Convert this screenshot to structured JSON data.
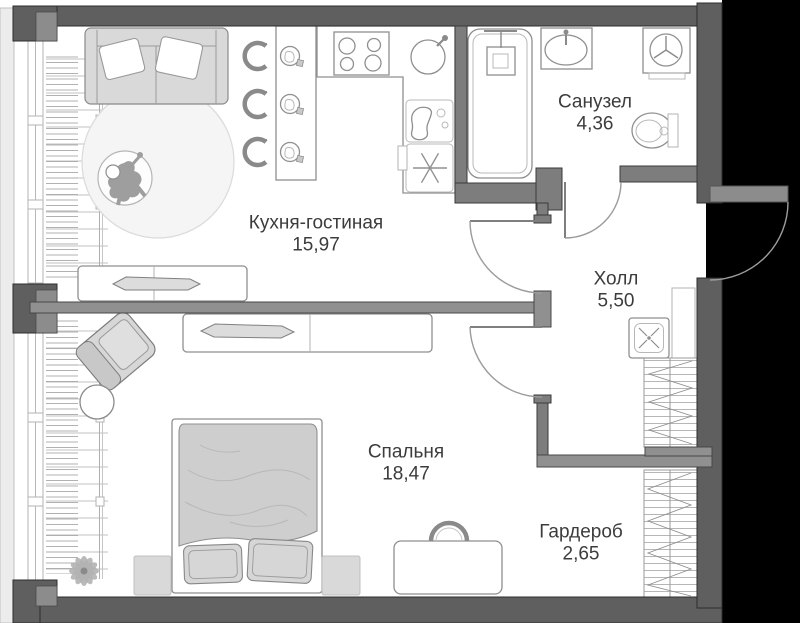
{
  "rooms": [
    {
      "id": "kitchen-living",
      "name": "Кухня-гостиная",
      "area": "15,97"
    },
    {
      "id": "bathroom",
      "name": "Санузел",
      "area": "4,36"
    },
    {
      "id": "hall",
      "name": "Холл",
      "area": "5,50"
    },
    {
      "id": "bedroom",
      "name": "Спальня",
      "area": "18,47"
    },
    {
      "id": "wardrobe",
      "name": "Гардероб",
      "area": "2,65"
    }
  ],
  "colors": {
    "outside": "#000000",
    "outer-wall": "#5f5f5f",
    "inner-wall": "#7d7d7d",
    "light-wall": "#909090",
    "floor": "#ffffff",
    "line": "#8f8f8f",
    "furniture-fill": "#d9d9d9",
    "text": "#3c3c3c"
  }
}
